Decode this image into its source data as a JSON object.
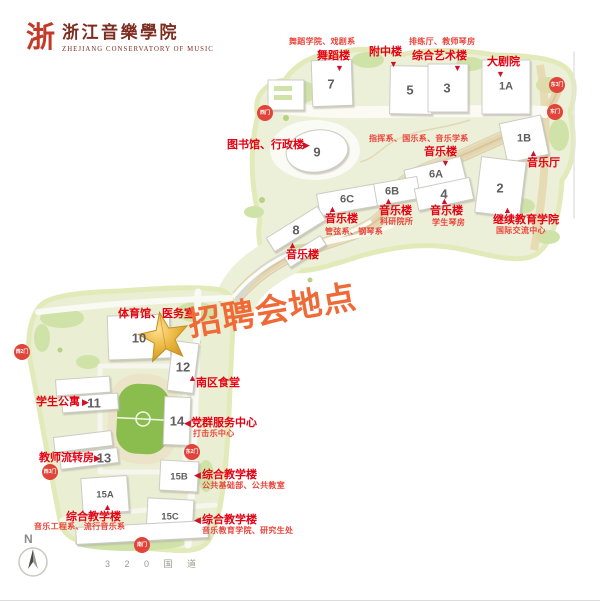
{
  "logo": {
    "seal_char": "浙",
    "title": "浙江音樂學院",
    "subtitle": "ZHEJIANG CONSERVATORY OF MUSIC"
  },
  "highlight": {
    "label": "招聘会地点",
    "color": "#f06a38"
  },
  "icons": {
    "marker_up": "▲",
    "marker_down": "▼",
    "marker_left": "◀",
    "marker_right": "▶",
    "star": "★"
  },
  "compass": {
    "north": "N"
  },
  "road": {
    "label": "3 2 0 国 道"
  },
  "colors": {
    "label_red": "#e50012",
    "note_red": "#ea463d",
    "gate_red": "#e0443a",
    "land": "#edf0d8",
    "field_green": "#8abc4e",
    "star_gold": "#e8b33a"
  },
  "gates": [
    {
      "label": "西门"
    },
    {
      "label": "东3门"
    },
    {
      "label": "东门"
    },
    {
      "label": "西2门"
    },
    {
      "label": "东2门"
    },
    {
      "label": "西3门"
    },
    {
      "label": "南门"
    }
  ],
  "buildings": [
    {
      "num": "7"
    },
    {
      "num": "5"
    },
    {
      "num": "3"
    },
    {
      "num": "1A"
    },
    {
      "num": "1B"
    },
    {
      "num": "9"
    },
    {
      "num": "6A"
    },
    {
      "num": "6B"
    },
    {
      "num": "6C"
    },
    {
      "num": "4"
    },
    {
      "num": "2"
    },
    {
      "num": "8"
    },
    {
      "num": "10"
    },
    {
      "num": "12"
    },
    {
      "num": "11"
    },
    {
      "num": "14"
    },
    {
      "num": "13"
    },
    {
      "num": "15B"
    },
    {
      "num": "15A"
    },
    {
      "num": "15C"
    }
  ],
  "labels": [
    {
      "title": "舞蹈楼",
      "note": "舞蹈学院、戏剧系"
    },
    {
      "title": "附中楼"
    },
    {
      "title": "综合艺术楼",
      "note": "排练厅、教师琴房"
    },
    {
      "title": "大剧院"
    },
    {
      "title": "图书馆、行政楼"
    },
    {
      "note": "指挥系、国乐系、音乐学系"
    },
    {
      "title": "音乐楼"
    },
    {
      "title": "音乐厅"
    },
    {
      "title": "音乐楼",
      "note": "科研院所"
    },
    {
      "title": "音乐楼",
      "note": "学生琴房"
    },
    {
      "title": "继续教育学院",
      "note": "国际交流中心"
    },
    {
      "title": "音乐楼",
      "note": "管弦系、钢琴系"
    },
    {
      "title": "音乐楼"
    },
    {
      "title": "体育馆、医务室"
    },
    {
      "title": "南区食堂"
    },
    {
      "title": "学生公寓"
    },
    {
      "title": "党群服务中心",
      "note": "打击乐中心"
    },
    {
      "title": "教师流转房"
    },
    {
      "title": "综合教学楼",
      "note": "公共基础部、公共教室"
    },
    {
      "title": "综合教学楼",
      "note": "音乐工程系、流行音乐系"
    },
    {
      "title": "综合教学楼",
      "note": "音乐教育学院、研究生处"
    }
  ]
}
